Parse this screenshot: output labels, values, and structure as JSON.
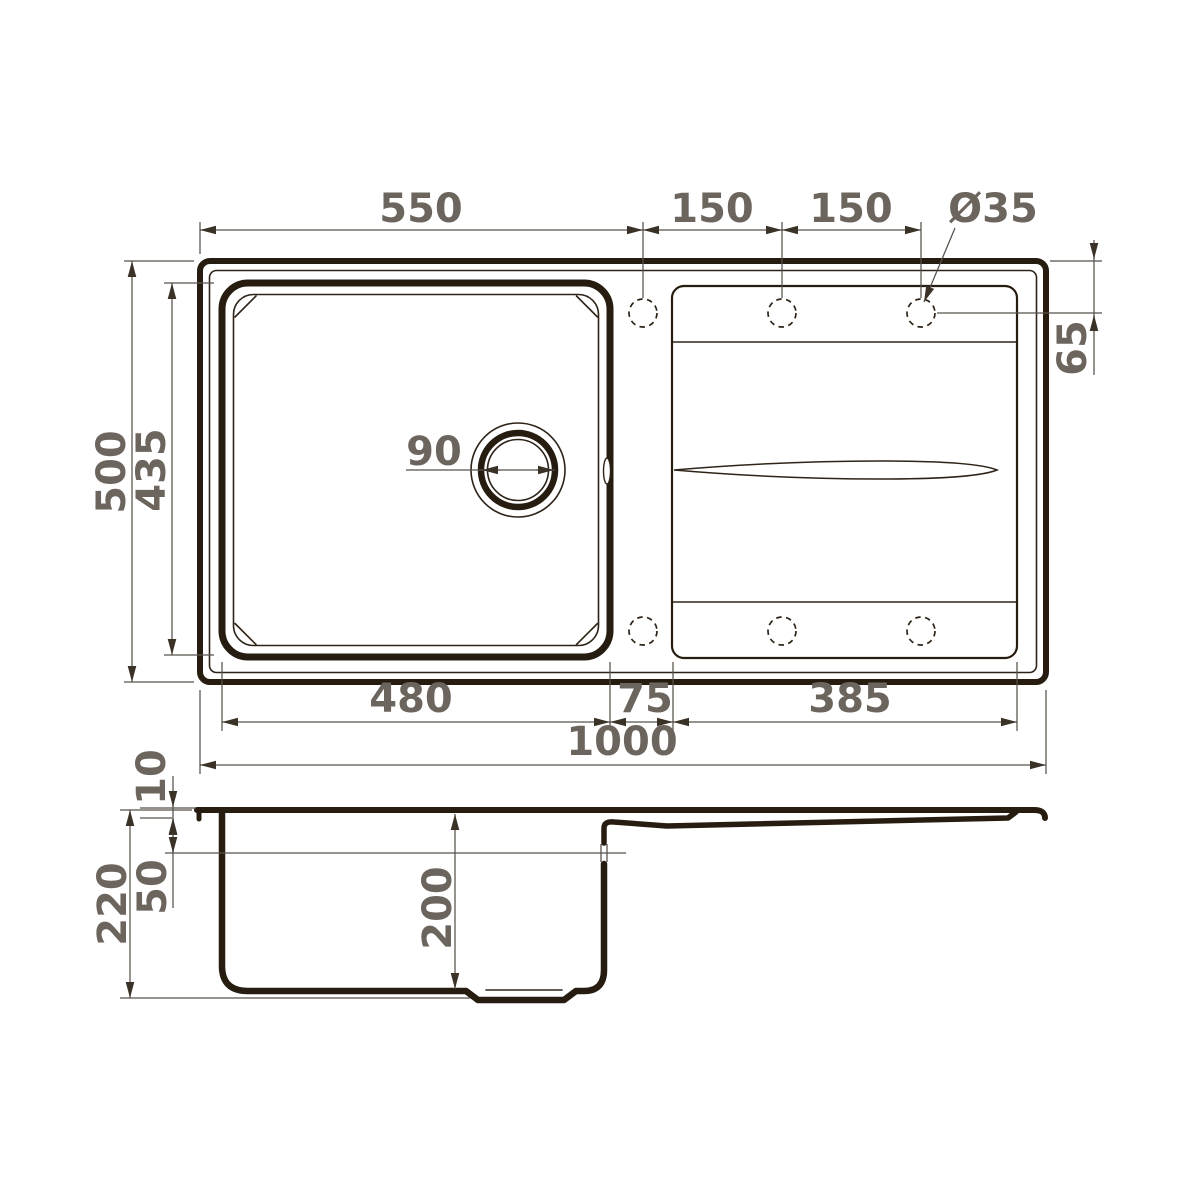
{
  "drawing": {
    "subject": "kitchen-sink-dimension-drawing",
    "colors": {
      "outline": "#271c10",
      "dim_line": "#57514b",
      "dim_text": "#6b655e",
      "arrow": "#3a3127",
      "background": "#ffffff"
    },
    "dims_top": {
      "edge_to_first_hole": "550",
      "hole_pitch_a": "150",
      "hole_pitch_b": "150",
      "tap_hole_diameter": "Ø35",
      "hole_offset_from_edge": "65",
      "overall_depth": "500",
      "bowl_depth_outer": "435",
      "drain_diameter": "90",
      "bowl_width": "480",
      "gap_bowl_to_drainboard": "75",
      "drainboard_width": "385",
      "overall_length": "1000"
    },
    "dims_side": {
      "rim_height": "10",
      "ledge_depth": "50",
      "overall_height": "220",
      "bowl_depth": "200"
    }
  }
}
